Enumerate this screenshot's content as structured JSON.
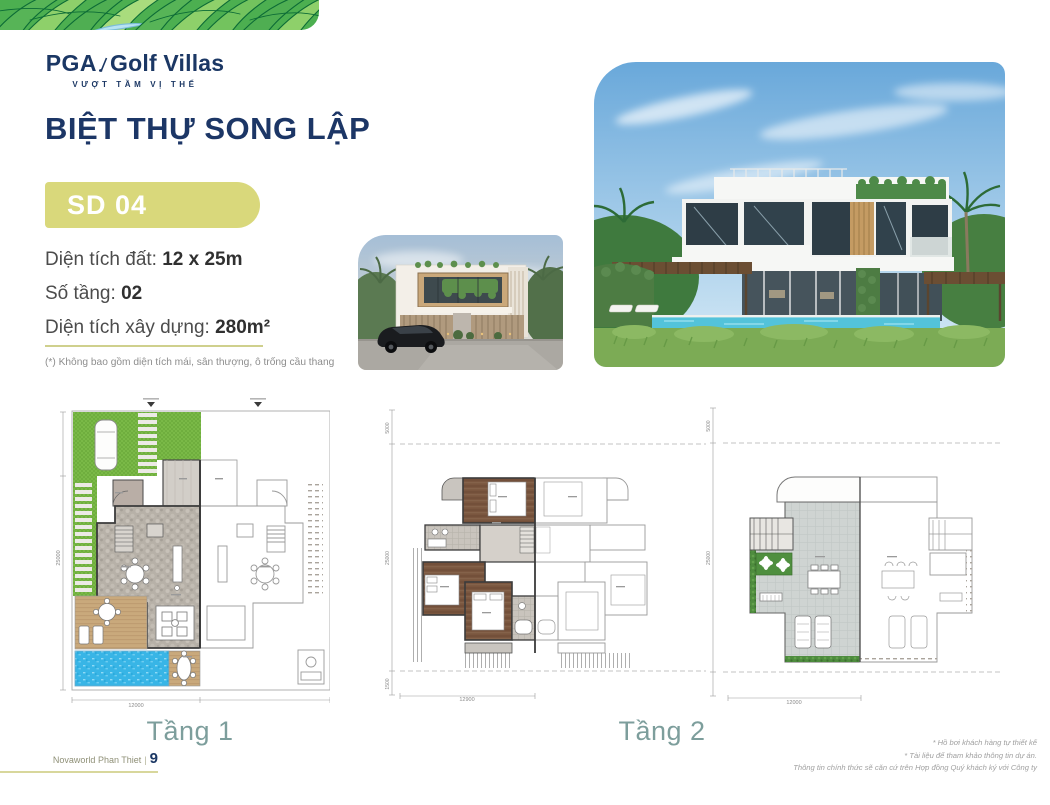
{
  "logo": {
    "brand": "PGA",
    "suffix": "Golf Villas",
    "tagline": "VƯỢT TẦM VỊ THẾ"
  },
  "page_title": "BIỆT THỰ SONG LẬP",
  "model_badge": "SD 04",
  "specs": [
    {
      "label": "Diện tích đất: ",
      "value": "12 x 25m"
    },
    {
      "label": "Số tầng: ",
      "value": "02"
    },
    {
      "label": "Diện tích xây dựng: ",
      "value": "280m²"
    }
  ],
  "footnote": "(*) Không bao gồm diện tích mái, sân thượng, ô trống cầu thang",
  "floor_plans": {
    "labels": {
      "floor1": "Tầng 1",
      "floor2": "Tầng 2"
    },
    "plan1": {
      "width_dim": "12000",
      "depth_dim": "25000"
    },
    "plan2": {
      "width_dim": "12900",
      "depth_dim": "25000",
      "front_setback_dim": "5000",
      "rear_setback_dim": "1500"
    },
    "plan3": {
      "width_dim": "12000",
      "depth_dim": "25000",
      "front_setback_dim": "5000"
    }
  },
  "footer": {
    "project": "Novaworld Phan Thiet",
    "separator": "|",
    "page_number": "9",
    "disclaimers": [
      "* Hồ bơi khách hàng tự thiết kế",
      "* Tài liệu để tham khảo thông tin dự án.",
      "Thông tin chính thức sẽ căn cứ trên Hợp đồng Quý khách ký với Công ty"
    ]
  },
  "colors": {
    "brand_navy": "#1b3764",
    "badge_olive": "#d9d87b",
    "divider_olive": "#cfd08d",
    "floor_label_teal": "#7d9e9c",
    "pool_blue": "#38b5e6",
    "lawn_green": "#6fae3e",
    "leaf_green": "#4caf50"
  }
}
